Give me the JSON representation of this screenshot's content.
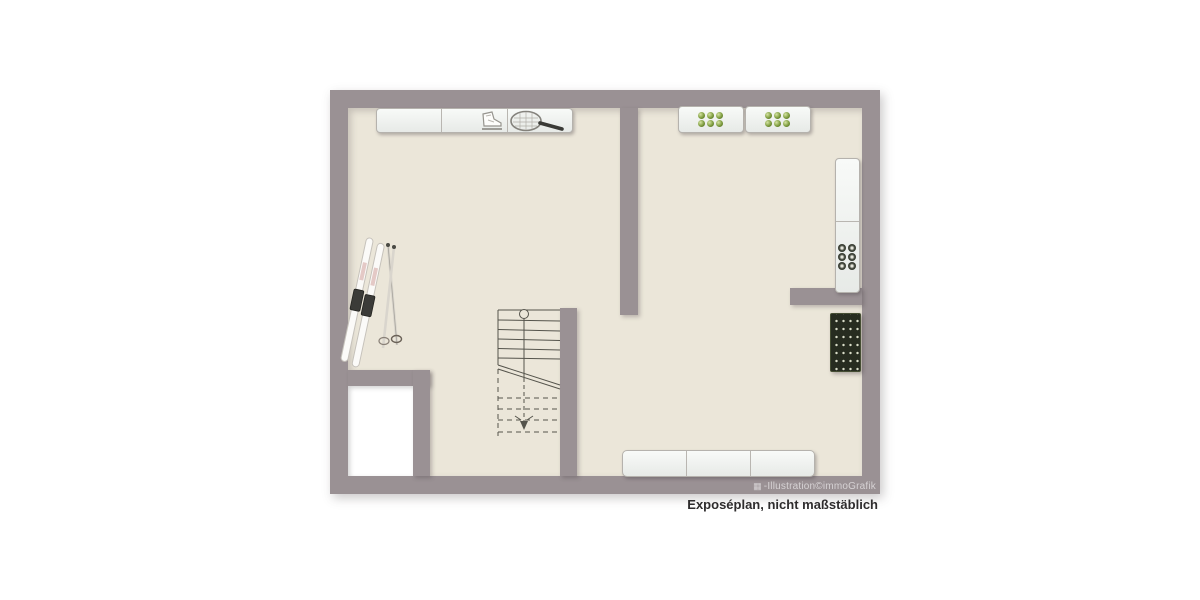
{
  "plan": {
    "type": "floor-plan",
    "caption": "Exposéplan, nicht maßstäblich",
    "watermark": "-Illustration©immoGrafik",
    "watermark_icon": "▦",
    "colors": {
      "background": "#ffffff",
      "wall": "#9a9194",
      "floor": "#ebe6d9",
      "furniture": "#f2f4f2",
      "accent_green": "#7d9c3e",
      "dark_item": "#272c20",
      "caption_text": "#2e2c2d",
      "watermark_text": "#d6d2d4"
    },
    "furniture": {
      "wall_shelf": {
        "label": "wall shelf with ice skate and tennis racket",
        "sections": 3
      },
      "bottle_shelf_left": {
        "label": "shelf with bottles",
        "bottles": 6
      },
      "bottle_shelf_right": {
        "label": "shelf with bottles",
        "bottles": 6
      },
      "tall_cabinet": {
        "label": "tall cabinet with bottles",
        "bottles": 6
      },
      "wine_rack": {
        "label": "wine rack"
      },
      "skis": {
        "label": "skis with poles"
      },
      "staircase": {
        "label": "staircase"
      },
      "bench": {
        "label": "bench / sideboard",
        "sections": 3
      }
    }
  }
}
